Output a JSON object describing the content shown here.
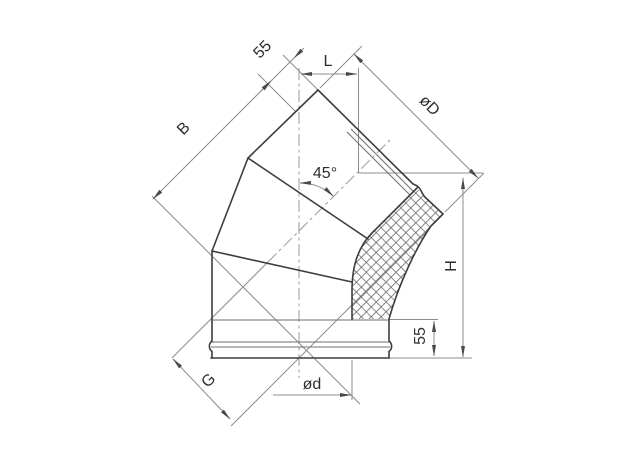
{
  "drawing": {
    "labels": {
      "length_b": "B",
      "socket_top": "55",
      "length_l": "L",
      "outer_diameter": "øD",
      "angle": "45°",
      "height_h": "H",
      "socket_bottom": "55",
      "length_g": "G",
      "inner_diameter": "ød"
    },
    "colors": {
      "background": "#ffffff",
      "object_line": "#3d3d3d",
      "thin_line": "#8c8c8c",
      "centerline": "#9a9a9a",
      "arrow": "#4a4a4a",
      "text": "#2e2e2e"
    }
  }
}
